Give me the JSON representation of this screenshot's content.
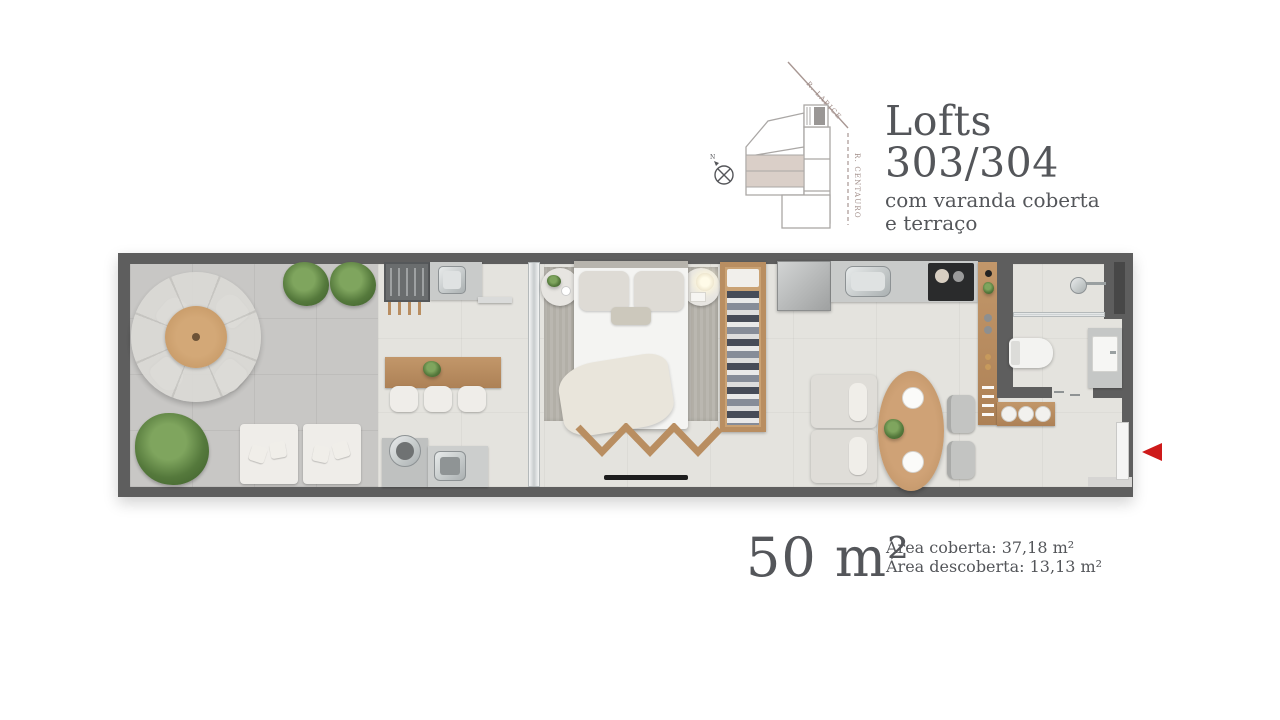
{
  "header": {
    "title_line1": "Lofts",
    "title_line2": "303/304",
    "subtitle_line1": "com varanda coberta",
    "subtitle_line2": "e terraço",
    "street_diagonal": "R. LARICE",
    "street_vertical": "R. CENTAURO",
    "compass_north": "N"
  },
  "areas": {
    "total": "50 m²",
    "covered": "Área coberta: 37,18 m²",
    "uncovered": "Área descoberta: 13,13 m²"
  },
  "colors": {
    "wall": "#5e5e5e",
    "terrace": "#c8c7c5",
    "interior": "#e4e3de",
    "wood": "#b98e61",
    "counter": "#c9cbca",
    "softwhite": "#efede9",
    "fabric": "#dedbd5",
    "rug": "#b6b3ab",
    "title": "#54565a",
    "street": "#a08d88",
    "keyline": "#aaa7a5",
    "highlight": "#dacfc8",
    "red": "#ce1a1a"
  }
}
